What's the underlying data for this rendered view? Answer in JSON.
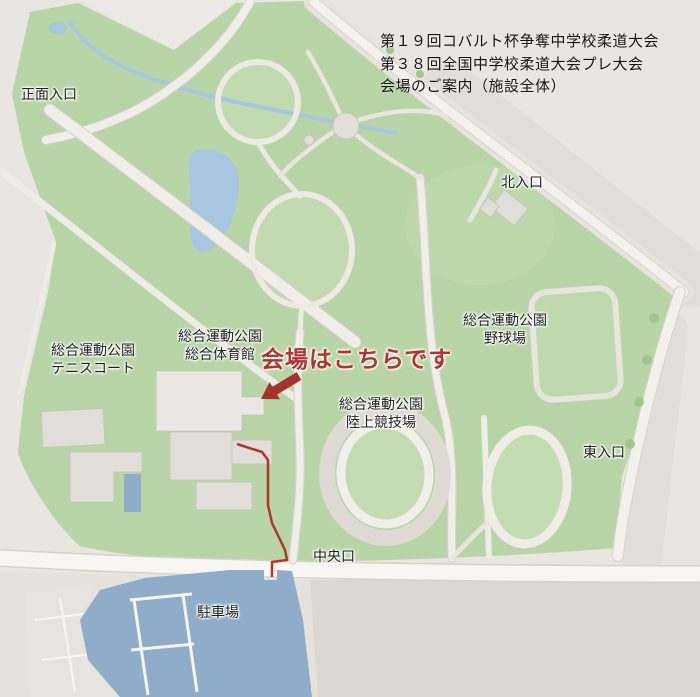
{
  "title": {
    "line1": "第１９回コバルト杯争奪中学校柔道大会",
    "line2": "第３８回全国中学校柔道大会プレ大会",
    "line3": "会場のご案内（施設全体）"
  },
  "venue_callout": {
    "text": "会場はこちらです",
    "icon": "arrow-down-left-icon",
    "color": "#b2342c"
  },
  "map": {
    "entrances": [
      {
        "id": "main",
        "label": "正面入口"
      },
      {
        "id": "north",
        "label": "北入口"
      },
      {
        "id": "east",
        "label": "東入口"
      },
      {
        "id": "central",
        "label": "中央口"
      }
    ],
    "facilities": [
      {
        "id": "tennis",
        "line1": "総合運動公園",
        "line2": "テニスコート"
      },
      {
        "id": "gymnasium",
        "line1": "総合運動公園",
        "line2": "総合体育館"
      },
      {
        "id": "baseball",
        "line1": "総合運動公園",
        "line2": "野球場"
      },
      {
        "id": "athletics",
        "line1": "総合運動公園",
        "line2": "陸上競技場"
      },
      {
        "id": "parking",
        "label": "駐車場"
      }
    ],
    "colors": {
      "background": "#e9e5e0",
      "park_green": "#b7d5a6",
      "road_white": "#f5f2ee",
      "water_blue": "#a9c6e1",
      "parking_blue": "#8fadc8",
      "building_gray": "#e1ddd8",
      "route_red": "#b2342c"
    }
  }
}
